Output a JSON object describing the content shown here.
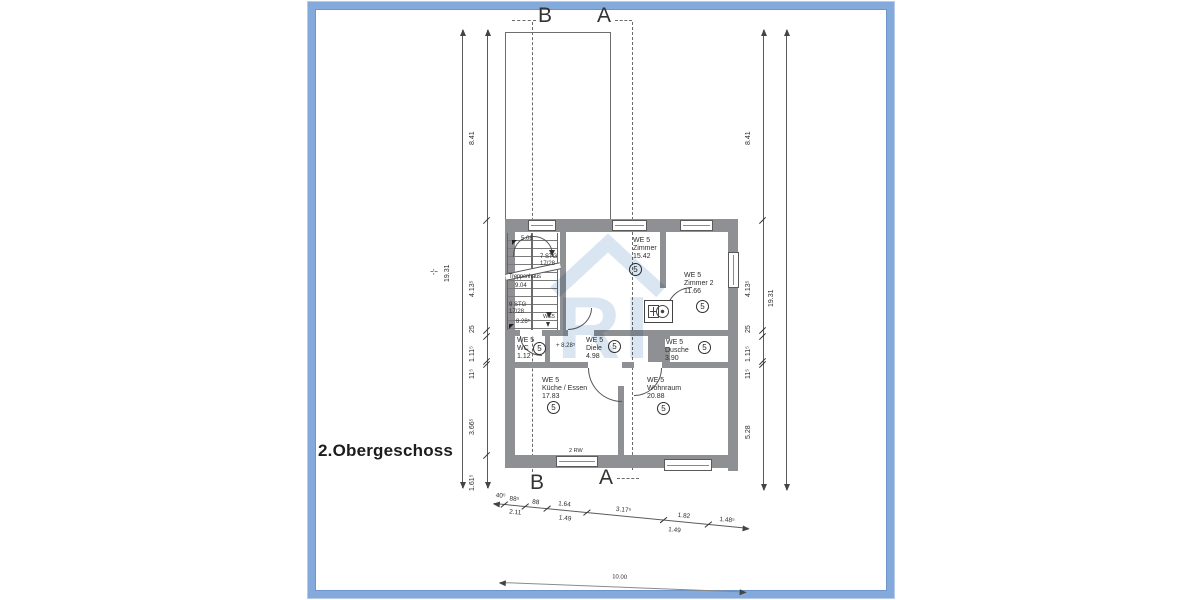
{
  "title": "2.Obergeschoss",
  "sections": {
    "b": "B",
    "a": "A"
  },
  "watermark": {
    "text": "RI"
  },
  "rooms": [
    {
      "unit": "WE 5",
      "name": "Zimmer",
      "area": "15.42",
      "badge": "5"
    },
    {
      "unit": "WE 5",
      "name": "Zimmer 2",
      "area": "11.66",
      "badge": "5"
    },
    {
      "unit": "WE 5",
      "name": "WC",
      "area": "1.12",
      "badge": "5"
    },
    {
      "unit": "WE 5",
      "name": "Diele",
      "area": "4.98",
      "badge": "5",
      "level": "+ 8.28⁵"
    },
    {
      "unit": "WE 5",
      "name": "Dusche",
      "area": "3.90",
      "badge": "5"
    },
    {
      "unit": "WE 5",
      "name": "Küche / Essen",
      "area": "17.83",
      "badge": "5"
    },
    {
      "unit": "WE 5",
      "name": "Wohnraum",
      "area": "20.88",
      "badge": "5"
    }
  ],
  "stairs": {
    "name": "Treppenhaus",
    "area": "9.04",
    "flight_a": "7 STG",
    "riser_a": "17/28",
    "flight_b": "9 STG",
    "riser_b": "17/28",
    "level_top": "5.08",
    "level_bottom": "8.28⁵",
    "unit_tag": "WE5"
  },
  "window_label": "2 RW",
  "dims": {
    "left_outer": "19.31",
    "left_inner": [
      "8.41",
      "4.13⁵",
      "25",
      "1.11⁵",
      "11⁵",
      "3.66⁵",
      "1.61⁵"
    ],
    "right_inner": [
      "8.41",
      "4.13⁵",
      "25",
      "1.11⁵",
      "11⁵",
      "5.28"
    ],
    "right_outer": "19.31",
    "bottom_upper": [
      "40⁵",
      "88⁵",
      "88",
      "1.64",
      "3.17⁵",
      "1.82",
      "1.48⁵"
    ],
    "bottom_lower": [
      "2.11",
      "1.49",
      "1.49"
    ],
    "bottom_total": "10.00",
    "axis_mark": "-¦-"
  },
  "colors": {
    "frame": "#83aadb",
    "wall": "#8e9094",
    "watermark": "#b9cfe6"
  }
}
